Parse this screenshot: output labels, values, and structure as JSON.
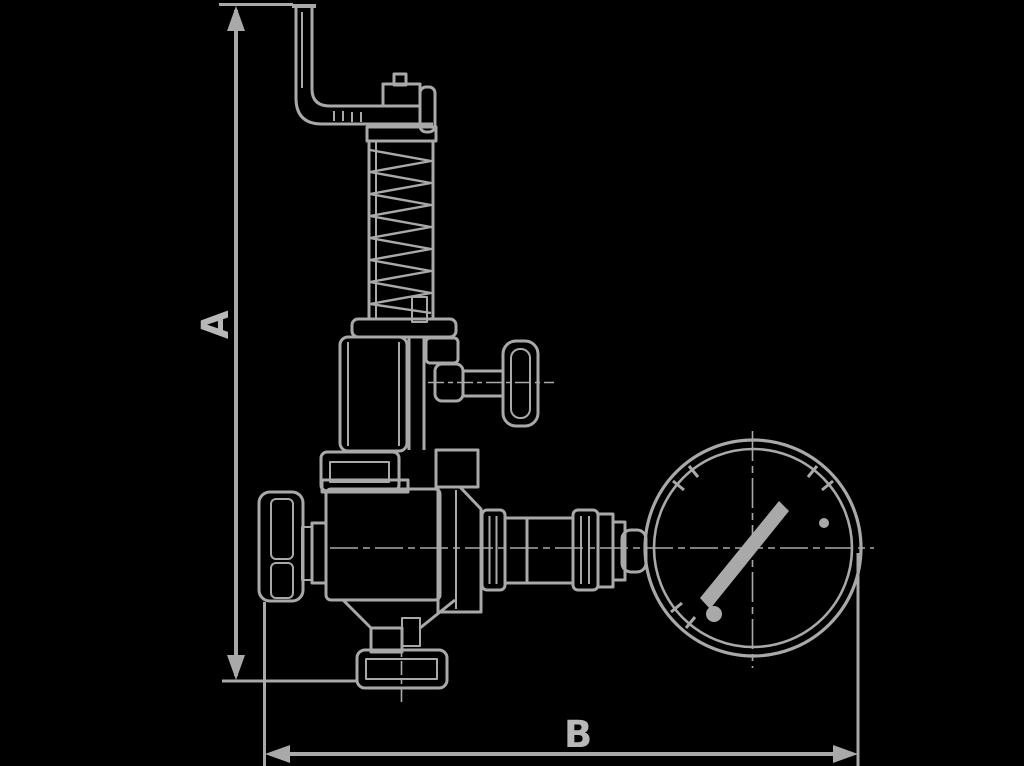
{
  "canvas": {
    "width": 1024,
    "height": 766,
    "background_color": "#000000",
    "line_color": "#a9a9a9",
    "label_color": "#b8b8b8"
  },
  "labels": {
    "dimension_vertical": "A",
    "dimension_horizontal": "B"
  }
}
